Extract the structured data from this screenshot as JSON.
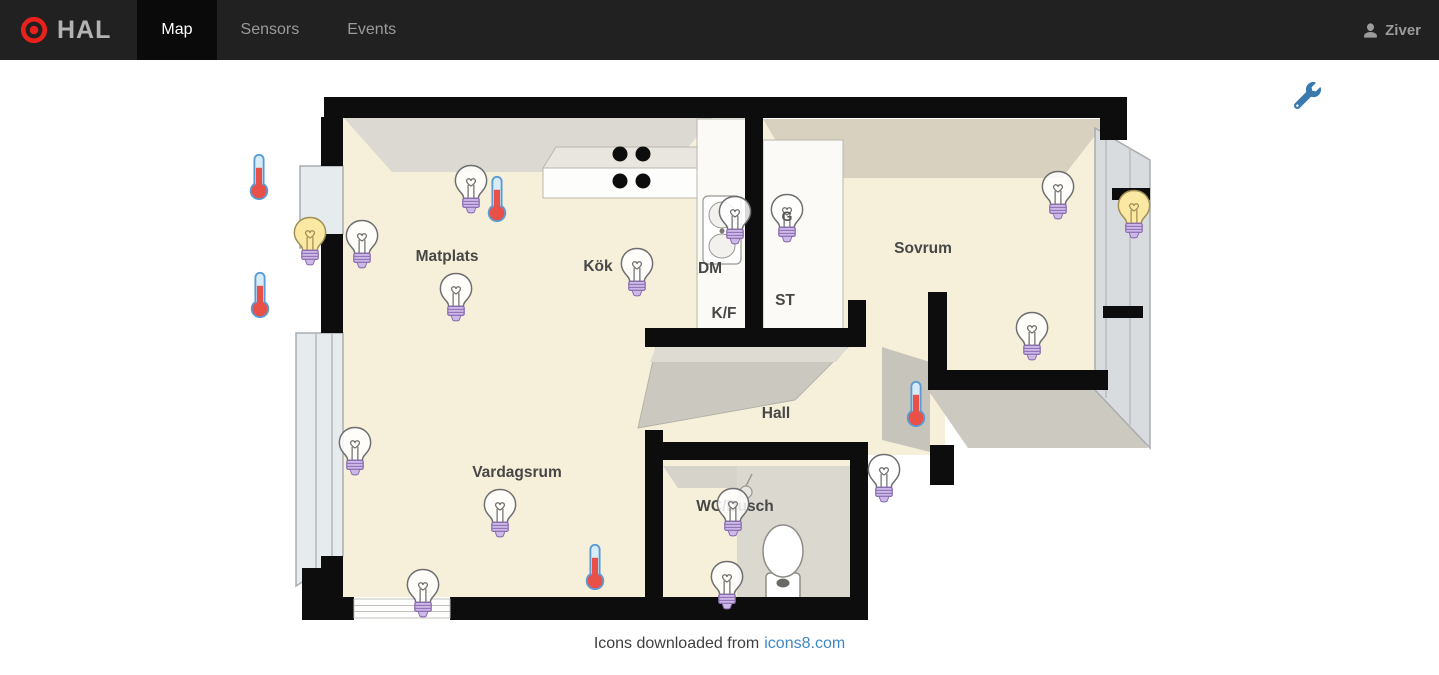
{
  "topbar": {
    "brand": "HAL",
    "tabs": [
      {
        "label": "Map",
        "active": true
      },
      {
        "label": "Sensors",
        "active": false
      },
      {
        "label": "Events",
        "active": false
      }
    ],
    "user": "Ziver"
  },
  "map": {
    "rooms": [
      {
        "name": "Matplats",
        "x": 447,
        "y": 257
      },
      {
        "name": "Kök",
        "x": 598,
        "y": 267
      },
      {
        "name": "DM",
        "x": 710,
        "y": 269
      },
      {
        "name": "K/F",
        "x": 724,
        "y": 314
      },
      {
        "name": "ST",
        "x": 785,
        "y": 301
      },
      {
        "name": "Sovrum",
        "x": 923,
        "y": 249
      },
      {
        "name": "Hall",
        "x": 776,
        "y": 414
      },
      {
        "name": "Vardagsrum",
        "x": 517,
        "y": 473
      },
      {
        "name": "WC/Dusch",
        "x": 735,
        "y": 507
      }
    ],
    "devices": [
      {
        "type": "thermometer",
        "x": 259,
        "y": 177
      },
      {
        "type": "thermometer",
        "x": 260,
        "y": 295
      },
      {
        "type": "bulb",
        "state": "on",
        "x": 310,
        "y": 240
      },
      {
        "type": "bulb",
        "state": "off",
        "x": 362,
        "y": 243
      },
      {
        "type": "bulb",
        "state": "off",
        "x": 471,
        "y": 188
      },
      {
        "type": "thermometer",
        "x": 497,
        "y": 199
      },
      {
        "type": "bulb",
        "state": "off",
        "x": 456,
        "y": 296
      },
      {
        "type": "bulb",
        "state": "off",
        "x": 637,
        "y": 271
      },
      {
        "type": "bulb",
        "state": "off",
        "x": 735,
        "y": 219
      },
      {
        "type": "bulb",
        "state": "off",
        "x": 787,
        "y": 217,
        "label": "G"
      },
      {
        "type": "bulb",
        "state": "off",
        "x": 1058,
        "y": 194
      },
      {
        "type": "bulb",
        "state": "on",
        "x": 1134,
        "y": 213
      },
      {
        "type": "bulb",
        "state": "off",
        "x": 1032,
        "y": 335
      },
      {
        "type": "thermometer",
        "x": 916,
        "y": 404
      },
      {
        "type": "bulb",
        "state": "off",
        "x": 884,
        "y": 477
      },
      {
        "type": "bulb",
        "state": "off",
        "x": 355,
        "y": 450
      },
      {
        "type": "bulb",
        "state": "off",
        "x": 500,
        "y": 512
      },
      {
        "type": "bulb",
        "state": "off",
        "x": 423,
        "y": 592
      },
      {
        "type": "thermometer",
        "x": 595,
        "y": 567
      },
      {
        "type": "bulb",
        "state": "off",
        "x": 733,
        "y": 511
      },
      {
        "type": "bulb",
        "state": "off",
        "x": 727,
        "y": 584
      }
    ]
  },
  "footer": {
    "text": "Icons downloaded from",
    "link": "icons8.com"
  },
  "colors": {
    "topbar_bg": "#212121",
    "active_tab_bg": "#0a0a0a",
    "brand_red": "#e8211d",
    "accent_blue": "#3a79ae",
    "link_blue": "#3f88c5",
    "bulb_on_fill": "#fbe8a3",
    "bulb_off_fill": "#ffffff",
    "bulb_base_purple": "#cdb9e8",
    "bulb_base_stroke": "#8a6cb0",
    "thermo_red": "#e85048",
    "thermo_blue": "#5b9bd5",
    "floor_beige": "#f6efd9",
    "wall_black": "#0d0d0d"
  }
}
